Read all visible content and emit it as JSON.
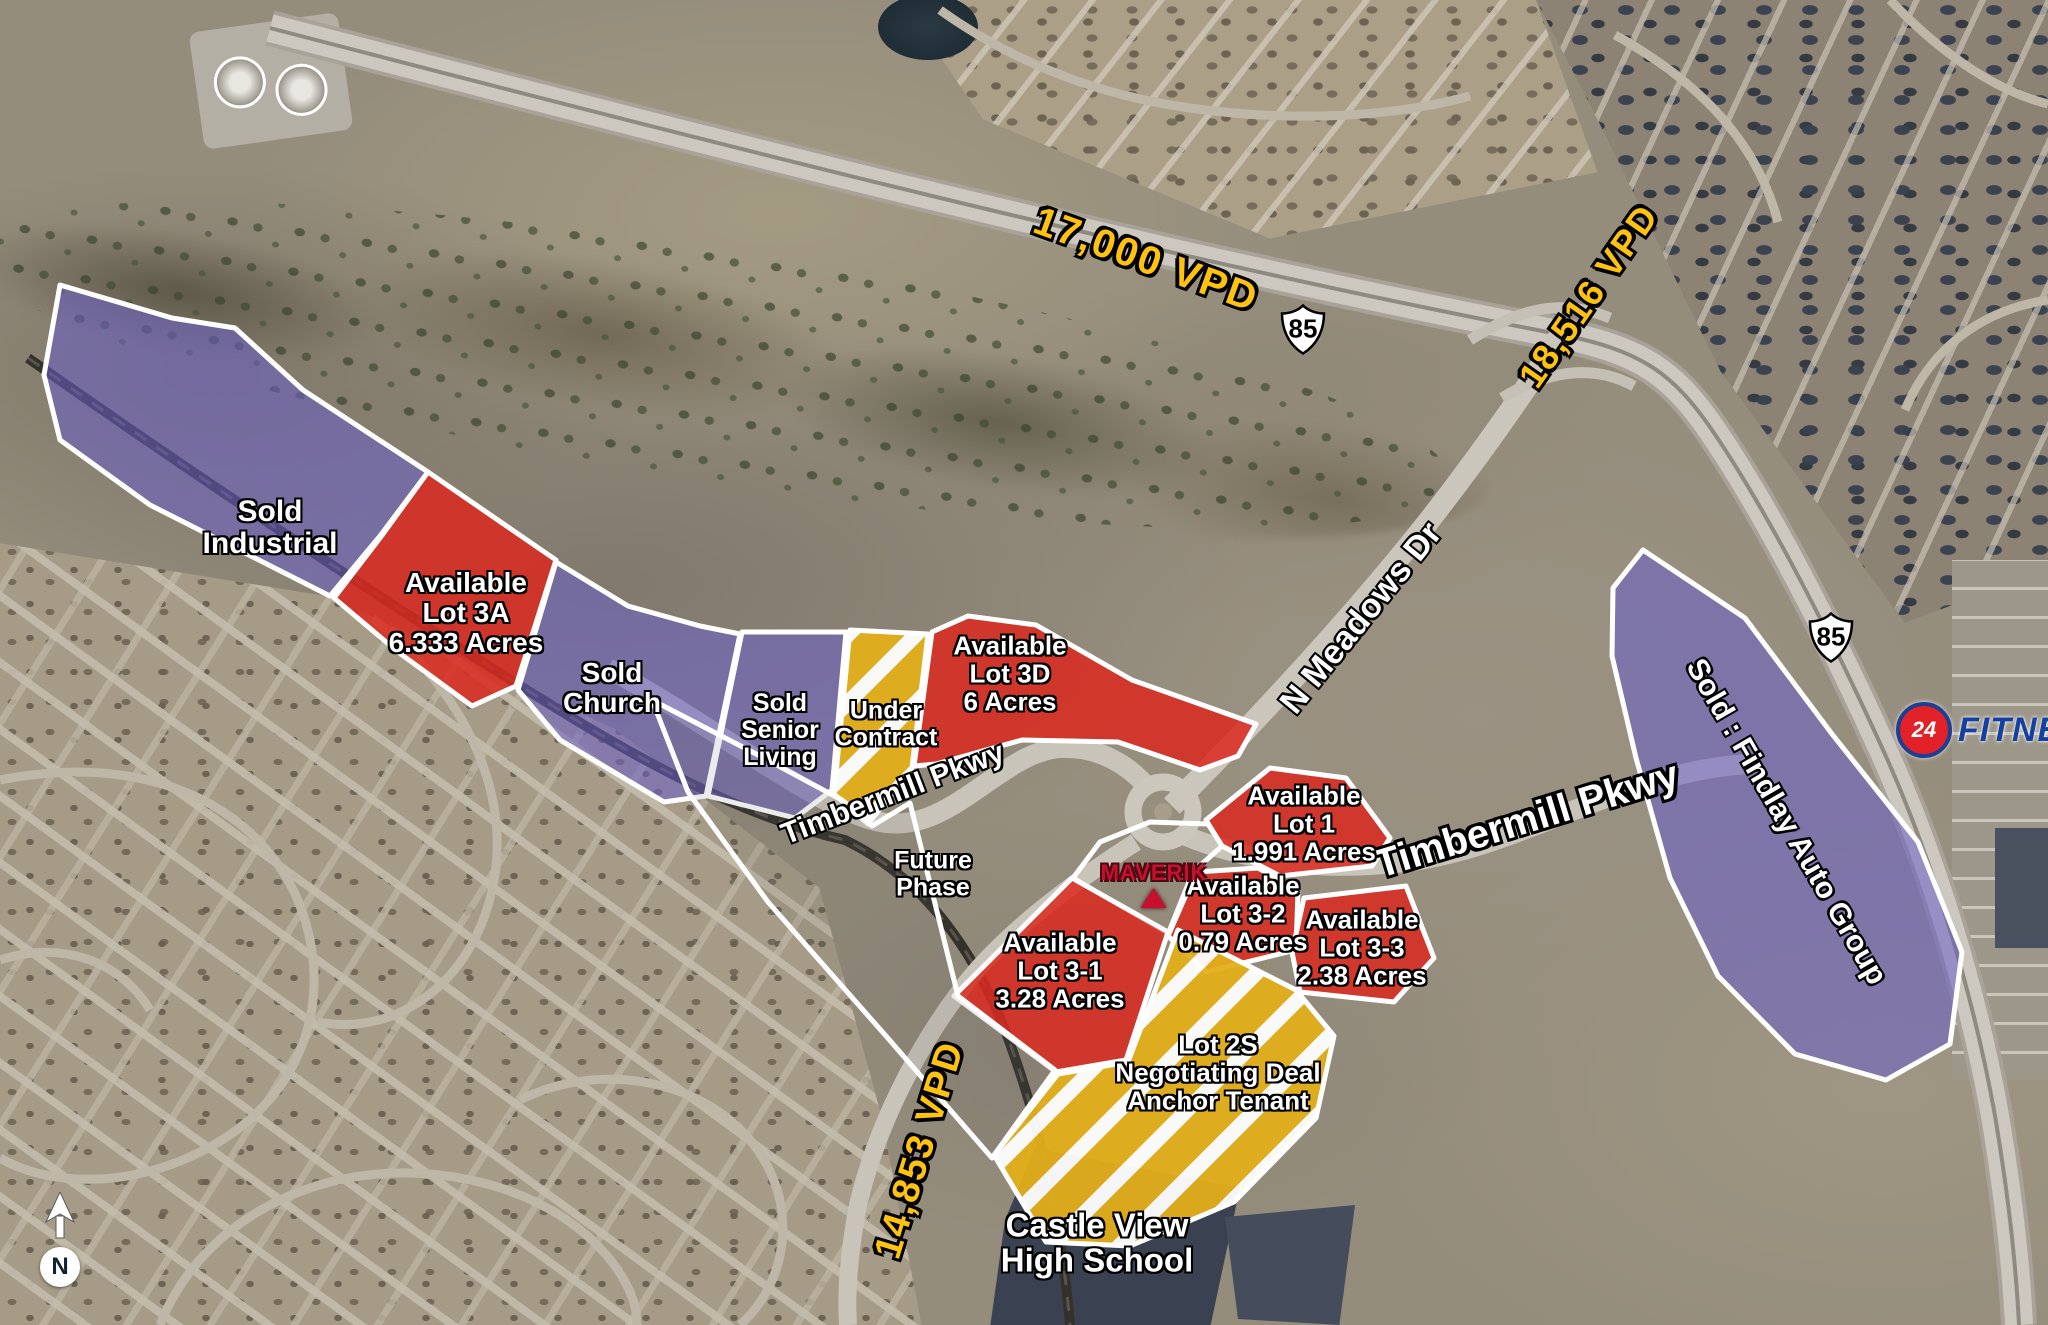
{
  "traffic_labels": [
    {
      "text": "17,000 VPD"
    },
    {
      "text": "18,516 VPD"
    },
    {
      "text": "14,853 VPD"
    }
  ],
  "highway_shields": [
    {
      "route": "85"
    },
    {
      "route": "85"
    }
  ],
  "road_labels": [
    {
      "text": "Timbermill Pkwy"
    },
    {
      "text": "N Meadows Dr"
    },
    {
      "text": "Timbermill Pkwy"
    }
  ],
  "parcels": [
    {
      "id": "sold-industrial",
      "status": "sold",
      "lines": [
        "Sold",
        "Industrial"
      ]
    },
    {
      "id": "lot-3a",
      "status": "available",
      "lines": [
        "Available",
        "Lot 3A",
        "6.333 Acres"
      ]
    },
    {
      "id": "sold-church",
      "status": "sold",
      "lines": [
        "Sold",
        "Church"
      ]
    },
    {
      "id": "sold-senior-living",
      "status": "sold",
      "lines": [
        "Sold",
        "Senior",
        "Living"
      ]
    },
    {
      "id": "under-contract",
      "status": "under-contract",
      "lines": [
        "Under",
        "Contract"
      ]
    },
    {
      "id": "lot-3d",
      "status": "available",
      "lines": [
        "Available",
        "Lot 3D",
        "6 Acres"
      ]
    },
    {
      "id": "lot-1",
      "status": "available",
      "lines": [
        "Available",
        "Lot 1",
        "1.991 Acres"
      ]
    },
    {
      "id": "lot-3-2",
      "status": "available",
      "lines": [
        "Available",
        "Lot 3-2",
        "0.79 Acres"
      ]
    },
    {
      "id": "lot-3-3",
      "status": "available",
      "lines": [
        "Available",
        "Lot 3-3",
        "2.38 Acres"
      ]
    },
    {
      "id": "lot-3-1",
      "status": "available",
      "lines": [
        "Available",
        "Lot 3-1",
        "3.28 Acres"
      ]
    },
    {
      "id": "lot-2s",
      "status": "negotiating",
      "lines": [
        "Lot 2S",
        "Negotiating Deal",
        "Anchor Tenant"
      ]
    },
    {
      "id": "sold-findlay",
      "status": "sold",
      "lines": [
        "Sold : Findlay Auto Group"
      ]
    },
    {
      "id": "future-phase",
      "status": "future",
      "lines": [
        "Future",
        "Phase"
      ]
    }
  ],
  "landmarks": {
    "school": {
      "lines": [
        "Castle View",
        "High School"
      ]
    },
    "maverik": {
      "name": "MAVERIK"
    },
    "fitness": {
      "number": "24",
      "name": "FITNESS"
    }
  },
  "compass": {
    "label": "N"
  },
  "colors": {
    "available_red": "#da2a1f",
    "sold_purple": "#695ec8",
    "negotiating_gold": "#e2ae1a",
    "parcel_border": "#ffffff",
    "traffic_yellow": "#ffc20e",
    "road_label_white": "#ffffff",
    "maverik_red": "#c8102e",
    "fitness_blue": "#1640a0",
    "fitness_red": "#e22128"
  }
}
